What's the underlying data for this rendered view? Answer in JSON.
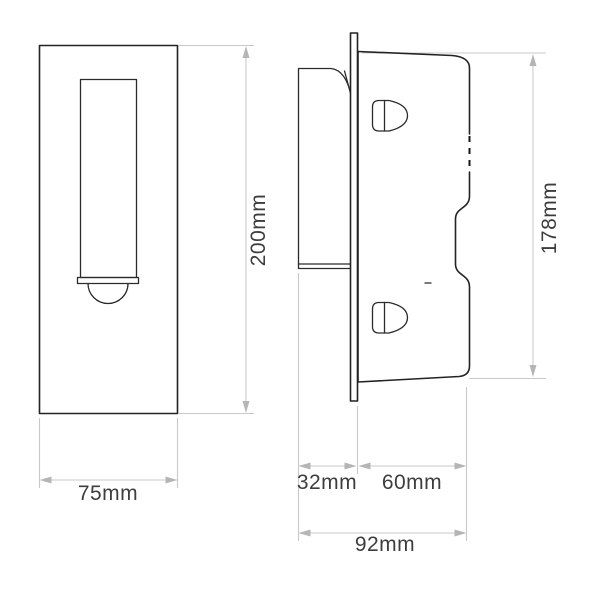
{
  "drawing": {
    "type": "technical-dimension-drawing",
    "subject": "recessed wall light fixture, front and side elevation views",
    "views": [
      {
        "id": "front-view",
        "description": "front elevation with rectangular lamp slot and dome lamp"
      },
      {
        "id": "side-view",
        "description": "side elevation with wall plate, recessed housing and mounting clips"
      }
    ]
  },
  "dimensions": [
    {
      "id": "front-height",
      "label": "200mm",
      "value": 200,
      "unit": "mm",
      "orientation": "vertical",
      "view": "front"
    },
    {
      "id": "front-width",
      "label": "75mm",
      "value": 75,
      "unit": "mm",
      "orientation": "horizontal",
      "view": "front"
    },
    {
      "id": "side-height",
      "label": "178mm",
      "value": 178,
      "unit": "mm",
      "orientation": "vertical",
      "view": "side"
    },
    {
      "id": "side-recess-depth",
      "label": "32mm",
      "value": 32,
      "unit": "mm",
      "orientation": "horizontal",
      "view": "side"
    },
    {
      "id": "side-body-depth",
      "label": "60mm",
      "value": 60,
      "unit": "mm",
      "orientation": "horizontal",
      "view": "side"
    },
    {
      "id": "side-total-depth",
      "label": "92mm",
      "value": 92,
      "unit": "mm",
      "orientation": "horizontal",
      "view": "side"
    }
  ],
  "colors": {
    "background": "#ffffff",
    "outline": "#232323",
    "dimension_line": "#c9c9c9",
    "dimension_arrow": "#b5b5b5",
    "label_text": "#3d3d3d"
  }
}
